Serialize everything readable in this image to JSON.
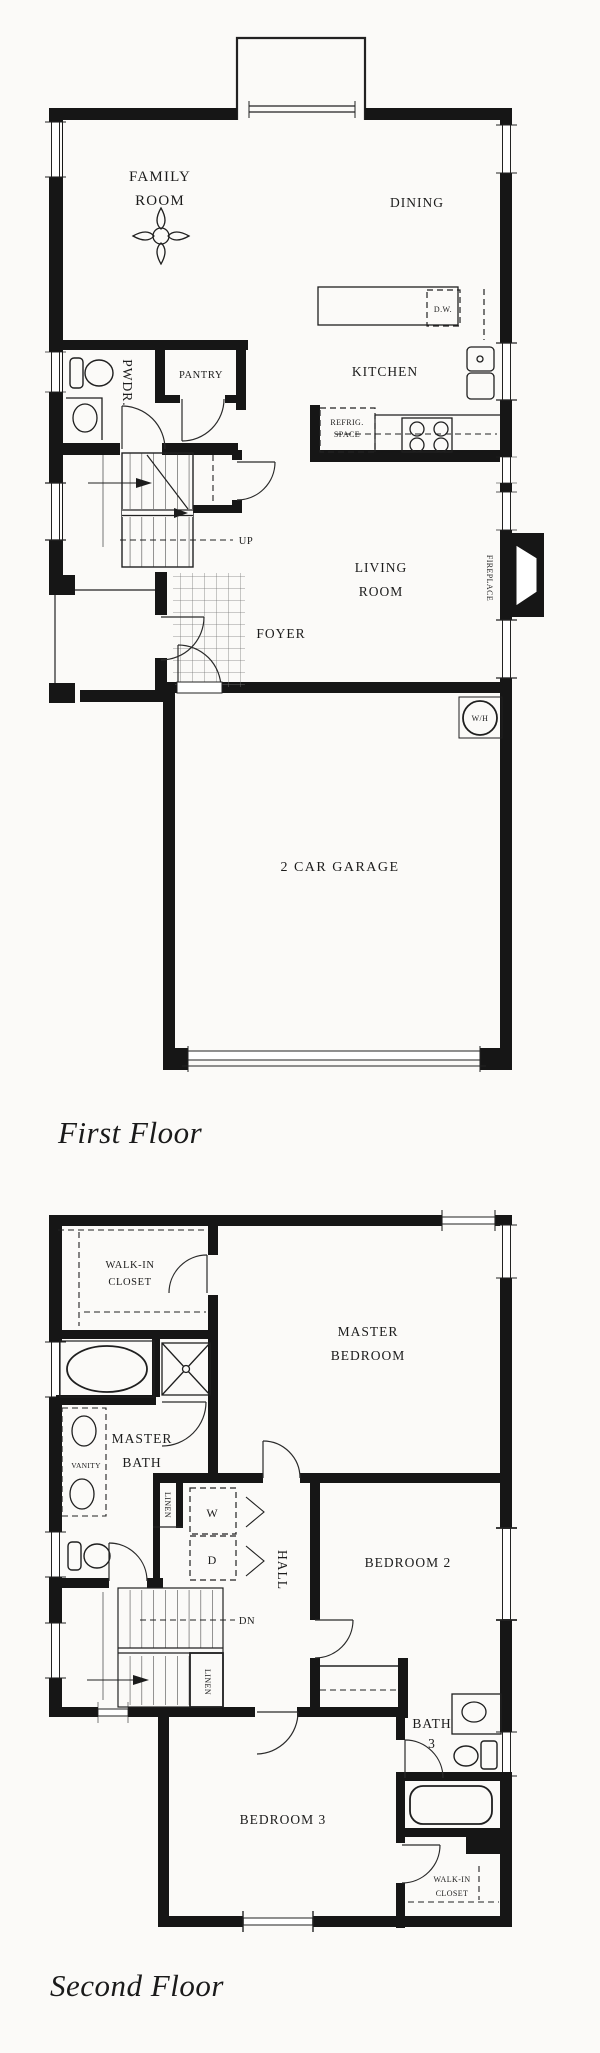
{
  "first_floor": {
    "title": "First Floor",
    "labels": {
      "family_room": [
        "FAMILY",
        "ROOM"
      ],
      "dining": "DINING",
      "kitchen": "KITCHEN",
      "dw": "D.W.",
      "refrig": [
        "REFRIG.",
        "SPACE"
      ],
      "pwdr": "PWDR.",
      "pantry": "PANTRY",
      "up": "UP",
      "living_room": [
        "LIVING",
        "ROOM"
      ],
      "fireplace": "FIREPLACE",
      "foyer": "FOYER",
      "water_heater": "W/H",
      "garage": "2 CAR GARAGE"
    }
  },
  "second_floor": {
    "title": "Second Floor",
    "labels": {
      "walk_in_closet": [
        "WALK-IN",
        "CLOSET"
      ],
      "master_bedroom": [
        "MASTER",
        "BEDROOM"
      ],
      "master_bath": [
        "MASTER",
        "BATH"
      ],
      "vanity": "VANITY",
      "linen_upper": "LINEN",
      "washer": "W",
      "dryer": "D",
      "hall": "HALL",
      "bedroom2": "BEDROOM 2",
      "dn": "DN",
      "linen_lower": "LINEN",
      "bath3": [
        "BATH",
        "3"
      ],
      "bedroom3": "BEDROOM 3",
      "walk_in_closet2": [
        "WALK-IN",
        "CLOSET"
      ]
    }
  },
  "colors": {
    "wall": "#161616",
    "line": "#222222",
    "text": "#1c1c1c",
    "paper": "#fbfaf8"
  }
}
